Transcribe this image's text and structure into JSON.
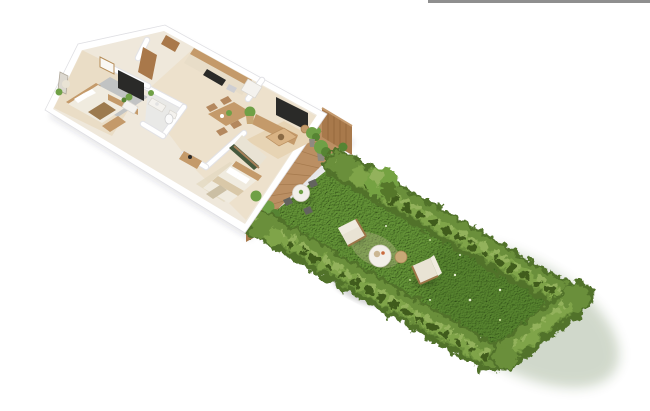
{
  "window": {
    "top_bar_color": "#8f8f8f"
  },
  "colors": {
    "top_bar": "#8f8f8f",
    "wall": "#ffffff",
    "wall_edge": "#dfdfe3",
    "floor": "#efe8db",
    "floor_wood": "#ecdfc9",
    "bedroom_floor": "#e8dac0",
    "bath_floor": "#e9e9e7",
    "kitchen_cabinet": "#e8ddc8",
    "wood": "#c49a6a",
    "wood_dark": "#a9784a",
    "deck": "#bb8f63",
    "deck_line": "#9e7347",
    "screen_wood": "#a8794b",
    "grass": "#4a7a26",
    "grass_light": "#7cab46",
    "hedge_base": "#51722c",
    "hedge_mid": "#6a8f3a",
    "hedge_light": "#7fa449",
    "hedge_highlight": "#93b25c",
    "hedge_shadow": "#3f5c1d",
    "plant": "#6fa046",
    "plant_dark": "#568433",
    "pot": "#8f8a80",
    "tv": "#2a2a28",
    "cream": "#e9e3d4",
    "cream_light": "#f0ebdf",
    "white_furn": "#f4f2ee",
    "table_white": "#f2efe9",
    "rattan": "#c8a876",
    "rug_gray": "#bfc1c3",
    "rug_beige": "#e7d3b2",
    "rug_bed2": "#e4d9c2",
    "sofa_green": "#46593d",
    "gray_furn": "#63635e",
    "gray_furn_light": "#a7a7a1",
    "shadow": "rgba(60,60,70,0.12)"
  },
  "scene": {
    "type": "3d-isometric-floor-plan-render",
    "areas": [
      "master-bedroom",
      "hallway",
      "bathroom",
      "kitchen",
      "dining-area",
      "living-room",
      "second-bedroom",
      "terrace",
      "garden"
    ],
    "garden_furniture": [
      "lounge-chair",
      "lounge-chair",
      "round-coffee-table",
      "wicker-side-table",
      "outdoor-daybed"
    ],
    "terrace_furniture": [
      "bistro-table",
      "bistro-chair",
      "bistro-chair",
      "bistro-chair",
      "potted-plants",
      "wooden-privacy-screen",
      "low-wooden-fence"
    ],
    "landscaping": [
      "lawn",
      "hedge-left-row",
      "hedge-right-row",
      "hedge-rear-row",
      "shrub"
    ]
  }
}
